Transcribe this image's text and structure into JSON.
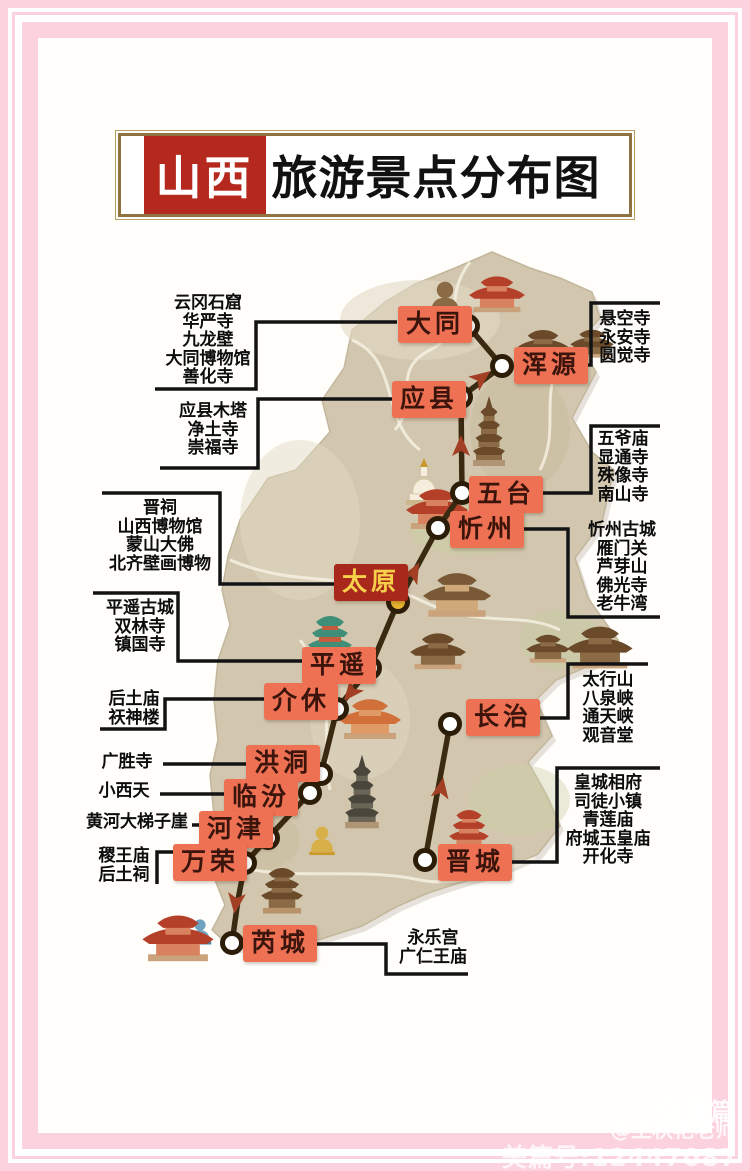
{
  "title": {
    "full": "山西旅游景点分布图",
    "highlight": "山西",
    "rest": "旅游景点分布图"
  },
  "watermark": {
    "brand": "美篇",
    "author": "@王秋艳老师",
    "id_line": "美篇号:12447087"
  },
  "colors": {
    "frame_pink": "#fbd2de",
    "title_red": "#b5281e",
    "title_gold_border": "#8f7340",
    "city_label_bg": "#ee7154",
    "city_label_text": "#3b140b",
    "capital_bg": "#a8291b",
    "capital_text": "#f6d14a",
    "route": "#3a2a12",
    "arrow": "#a23f24",
    "terrain": "#d2c7ae",
    "node_gold": "#e6b42e"
  },
  "map": {
    "cities": [
      {
        "id": "datong",
        "label": "大同",
        "label_x": 398,
        "label_y": 306,
        "node_x": 468,
        "node_y": 326,
        "capital": false
      },
      {
        "id": "hunyuan",
        "label": "浑源",
        "label_x": 514,
        "label_y": 347,
        "node_x": 502,
        "node_y": 366,
        "capital": false
      },
      {
        "id": "yingxian",
        "label": "应县",
        "label_x": 392,
        "label_y": 381,
        "node_x": 461,
        "node_y": 397,
        "capital": false
      },
      {
        "id": "wutai",
        "label": "五台",
        "label_x": 469,
        "label_y": 476,
        "node_x": 462,
        "node_y": 493,
        "capital": false
      },
      {
        "id": "xinzhou",
        "label": "忻州",
        "label_x": 450,
        "label_y": 511,
        "node_x": 438,
        "node_y": 528,
        "capital": false
      },
      {
        "id": "taiyuan",
        "label": "太原",
        "label_x": 334,
        "label_y": 564,
        "node_x": 398,
        "node_y": 602,
        "capital": true
      },
      {
        "id": "pingyao",
        "label": "平遥",
        "label_x": 302,
        "label_y": 647,
        "node_x": 370,
        "node_y": 668,
        "capital": false
      },
      {
        "id": "jiexiu",
        "label": "介休",
        "label_x": 264,
        "label_y": 683,
        "node_x": 337,
        "node_y": 709,
        "capital": false
      },
      {
        "id": "hongtong",
        "label": "洪洞",
        "label_x": 246,
        "label_y": 745,
        "node_x": 321,
        "node_y": 774,
        "capital": false
      },
      {
        "id": "linfen",
        "label": "临汾",
        "label_x": 224,
        "label_y": 779,
        "node_x": 310,
        "node_y": 793,
        "capital": false
      },
      {
        "id": "hejin",
        "label": "河津",
        "label_x": 199,
        "label_y": 811,
        "node_x": 268,
        "node_y": 838,
        "capital": false
      },
      {
        "id": "wanrong",
        "label": "万荣",
        "label_x": 173,
        "label_y": 844,
        "node_x": 245,
        "node_y": 863,
        "capital": false
      },
      {
        "id": "changzhi",
        "label": "长治",
        "label_x": 466,
        "label_y": 699,
        "node_x": 450,
        "node_y": 724,
        "capital": false
      },
      {
        "id": "jincheng",
        "label": "晋城",
        "label_x": 438,
        "label_y": 844,
        "node_x": 425,
        "node_y": 860,
        "capital": false
      },
      {
        "id": "ruicheng",
        "label": "芮城",
        "label_x": 243,
        "label_y": 925,
        "node_x": 232,
        "node_y": 943,
        "capital": false
      }
    ],
    "attractions": [
      {
        "id": "datong",
        "cx": 208,
        "top": 294,
        "lines": [
          "云冈石窟",
          "华严寺",
          "九龙壁",
          "大同博物馆",
          "善化寺"
        ]
      },
      {
        "id": "yingxian",
        "cx": 213,
        "top": 402,
        "lines": [
          "应县木塔",
          "净土寺",
          "崇福寺"
        ]
      },
      {
        "id": "taiyuan",
        "cx": 160,
        "top": 499,
        "lines": [
          "晋祠",
          "山西博物馆",
          "蒙山大佛",
          "北齐壁画博物"
        ]
      },
      {
        "id": "pingyao",
        "cx": 140,
        "top": 599,
        "lines": [
          "平遥古城",
          "双林寺",
          "镇国寺"
        ]
      },
      {
        "id": "jiexiu",
        "cx": 134,
        "top": 690,
        "lines": [
          "后土庙",
          "祆神楼"
        ]
      },
      {
        "id": "hongtong",
        "cx": 127,
        "top": 753,
        "lines": [
          "广胜寺"
        ]
      },
      {
        "id": "linfen",
        "cx": 124,
        "top": 782,
        "lines": [
          "小西天"
        ]
      },
      {
        "id": "hejin",
        "cx": 137,
        "top": 813,
        "lines": [
          "黄河大梯子崖"
        ]
      },
      {
        "id": "wanrong",
        "cx": 124,
        "top": 847,
        "lines": [
          "稷王庙",
          "后土祠"
        ]
      },
      {
        "id": "hunyuan",
        "cx": 625,
        "top": 310,
        "lines": [
          "悬空寺",
          "永安寺",
          "圆觉寺"
        ]
      },
      {
        "id": "wutai",
        "cx": 623,
        "top": 430,
        "lines": [
          "五爷庙",
          "显通寺",
          "殊像寺",
          "南山寺"
        ]
      },
      {
        "id": "xinzhou",
        "cx": 622,
        "top": 521,
        "lines": [
          "忻州古城",
          "雁门关",
          "芦芽山",
          "佛光寺",
          "老牛湾"
        ]
      },
      {
        "id": "changzhi",
        "cx": 608,
        "top": 671,
        "lines": [
          "太行山",
          "八泉峡",
          "通天峡",
          "观音堂"
        ]
      },
      {
        "id": "jincheng",
        "cx": 608,
        "top": 774,
        "lines": [
          "皇城相府",
          "司徒小镇",
          "青莲庙",
          "府城玉皇庙",
          "开化寺"
        ]
      },
      {
        "id": "ruicheng",
        "cx": 433,
        "top": 929,
        "lines": [
          "永乐宫",
          "广仁王庙"
        ]
      }
    ],
    "connectors": [
      {
        "id": "datong",
        "points": "155,389 256,389 256,322 397,322"
      },
      {
        "id": "yingxian",
        "points": "160,468 258,468 258,399 392,399"
      },
      {
        "id": "taiyuan",
        "points": "102,493 220,493 220,584 335,584"
      },
      {
        "id": "pingyao",
        "points": "93,593 178,593 178,661 303,661"
      },
      {
        "id": "jiexiu",
        "points": "100,729 165,729 165,699 264,699"
      },
      {
        "id": "hongtong",
        "points": "163,764 247,764"
      },
      {
        "id": "linfen",
        "points": "160,794 225,794"
      },
      {
        "id": "hejin",
        "points": "192,825 201,825"
      },
      {
        "id": "wanrong",
        "points": "157,884 157,852 175,852"
      },
      {
        "id": "hunyuan",
        "points": "660,303 591,303 591,365 572,365"
      },
      {
        "id": "wutai",
        "points": "660,426 591,426 591,493 536,493"
      },
      {
        "id": "xinzhou",
        "points": "514,529 568,529 568,617 660,617"
      },
      {
        "id": "changzhi",
        "points": "648,664 568,664 568,718 529,718"
      },
      {
        "id": "jincheng",
        "points": "660,768 557,768 557,862 504,862"
      },
      {
        "id": "ruicheng",
        "points": "306,944 386,944 386,974 468,974"
      }
    ],
    "route": {
      "main_points": "468,326 502,366 461,397 462,493 438,528 398,602 370,668 337,709 321,774 310,793 268,838 245,863 238,900 232,943",
      "branch_points": "450,724 425,860",
      "arrows": [
        [
          480,
          379,
          53
        ],
        [
          461,
          448,
          0
        ],
        [
          413,
          574,
          28
        ],
        [
          352,
          691,
          219
        ],
        [
          236,
          901,
          187
        ],
        [
          441,
          790,
          10
        ]
      ]
    },
    "illustrations": [
      {
        "type": "buddha",
        "x": 445,
        "y": 312,
        "s": 1.1,
        "v": "brown"
      },
      {
        "type": "temple",
        "x": 497,
        "y": 305,
        "s": 0.9,
        "v": "red"
      },
      {
        "type": "temple",
        "x": 543,
        "y": 357,
        "s": 0.85,
        "v": "brown"
      },
      {
        "type": "temple",
        "x": 592,
        "y": 352,
        "s": 0.7,
        "v": "brown"
      },
      {
        "type": "pagoda",
        "x": 489,
        "y": 460,
        "s": 1.0,
        "v": "brown"
      },
      {
        "type": "stupa",
        "x": 424,
        "y": 500,
        "s": 1.0,
        "v": "white"
      },
      {
        "type": "temple",
        "x": 437,
        "y": 521,
        "s": 1.0,
        "v": "red"
      },
      {
        "type": "temple",
        "x": 457,
        "y": 608,
        "s": 1.1,
        "v": "tan"
      },
      {
        "type": "tower",
        "x": 330,
        "y": 656,
        "s": 1.0,
        "v": "green"
      },
      {
        "type": "temple",
        "x": 438,
        "y": 662,
        "s": 0.9,
        "v": "brown"
      },
      {
        "type": "temple",
        "x": 600,
        "y": 660,
        "s": 1.05,
        "v": "brown"
      },
      {
        "type": "temple",
        "x": 548,
        "y": 657,
        "s": 0.7,
        "v": "brown"
      },
      {
        "type": "temple",
        "x": 370,
        "y": 731,
        "s": 1.0,
        "v": "orange"
      },
      {
        "type": "pagoda",
        "x": 362,
        "y": 822,
        "s": 1.05,
        "v": "dark"
      },
      {
        "type": "buddha",
        "x": 322,
        "y": 850,
        "s": 0.85,
        "v": "gold"
      },
      {
        "type": "tower",
        "x": 469,
        "y": 846,
        "s": 0.9,
        "v": "red"
      },
      {
        "type": "tower",
        "x": 282,
        "y": 906,
        "s": 0.95,
        "v": "brown"
      },
      {
        "type": "buddha",
        "x": 200,
        "y": 940,
        "s": 0.75,
        "v": "blue"
      },
      {
        "type": "temple",
        "x": 178,
        "y": 952,
        "s": 1.15,
        "v": "red"
      }
    ]
  }
}
